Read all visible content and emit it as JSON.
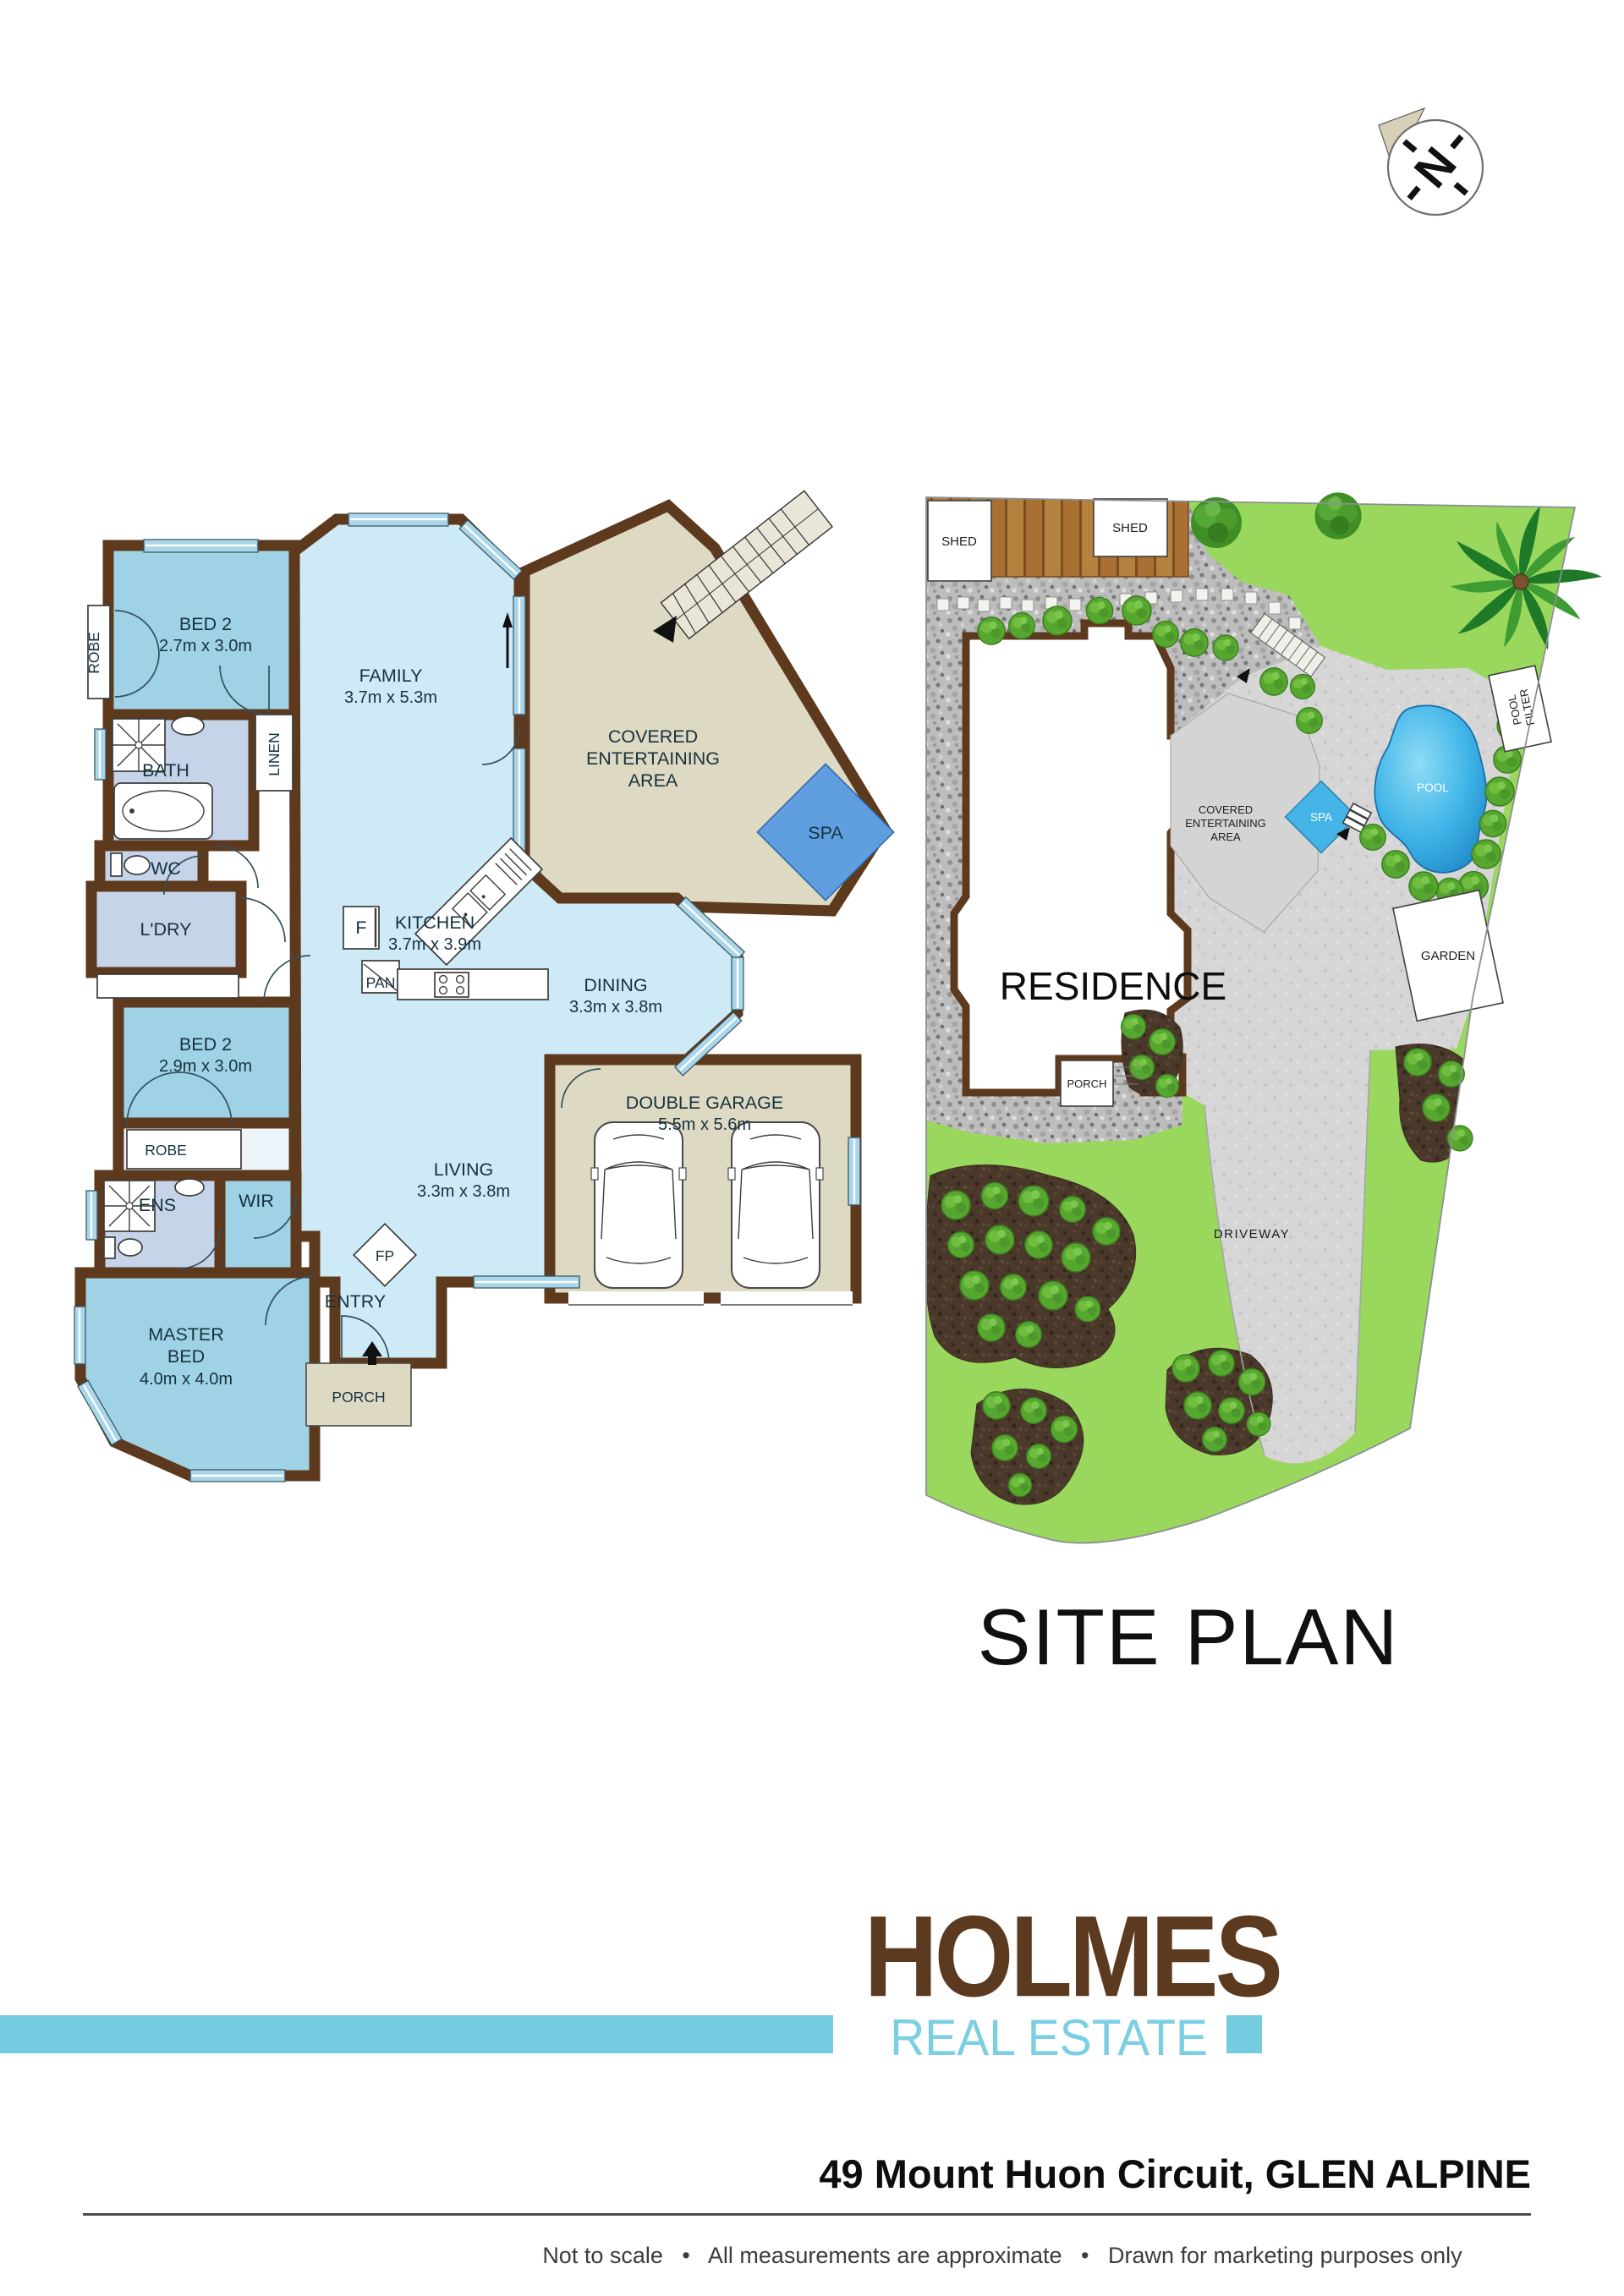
{
  "compass": {
    "north_label": "N"
  },
  "site_title": "SITE PLAN",
  "fp": {
    "robe_top": "ROBE",
    "bed2a": "BED 2",
    "bed2a_dims": "2.7m x 3.0m",
    "family": "FAMILY",
    "family_dims": "3.7m x 5.3m",
    "bath": "BATH",
    "linen": "LINEN",
    "wc": "WC",
    "ldry": "L'DRY",
    "covered1": "COVERED",
    "covered2": "ENTERTAINING",
    "covered3": "AREA",
    "spa": "SPA",
    "kitchen": "KITCHEN",
    "kitchen_dims": "3.7m x 3.9m",
    "fridge": "F",
    "pantry": "PAN",
    "dining": "DINING",
    "dining_dims": "3.3m x 3.8m",
    "bed2b": "BED 2",
    "bed2b_dims": "2.9m x 3.0m",
    "robe_mid": "ROBE",
    "ens": "ENS",
    "wir": "WIR",
    "master1": "MASTER",
    "master2": "BED",
    "master_dims": "4.0m x 4.0m",
    "living": "LIVING",
    "living_dims": "3.3m x 3.8m",
    "fp": "FP",
    "entry": "ENTRY",
    "porch": "PORCH",
    "garage": "DOUBLE GARAGE",
    "garage_dims": "5.5m x 5.6m"
  },
  "sp": {
    "shed1": "SHED",
    "shed2": "SHED",
    "pool_filter1": "POOL",
    "pool_filter2": "FILTER",
    "covered1": "COVERED",
    "covered2": "ENTERTAINING",
    "covered3": "AREA",
    "spa": "SPA",
    "pool": "POOL",
    "garden": "GARDEN",
    "residence": "RESIDENCE",
    "porch": "PORCH",
    "driveway": "DRIVEWAY"
  },
  "branding": {
    "name": "HOLMES",
    "sub": "REAL ESTATE",
    "address": "49 Mount Huon Circuit, GLEN ALPINE",
    "disclaimer": "Not to scale   •   All measurements are approximate   •   Drawn for marketing purposes only",
    "brand_color": "#5c3a20",
    "accent_color": "#74cce0"
  },
  "colors": {
    "wall_brown": "#5d3a1e",
    "room_light_blue": "#cfeaf7",
    "room_medium_blue": "#9fd2e5",
    "room_lavender": "#c6d4e9",
    "outdoor_beige": "#ded9c3",
    "spa_blue": "#5f9fe0",
    "grass_green": "#99d85c",
    "pool_blue": "#2d9fd8"
  }
}
